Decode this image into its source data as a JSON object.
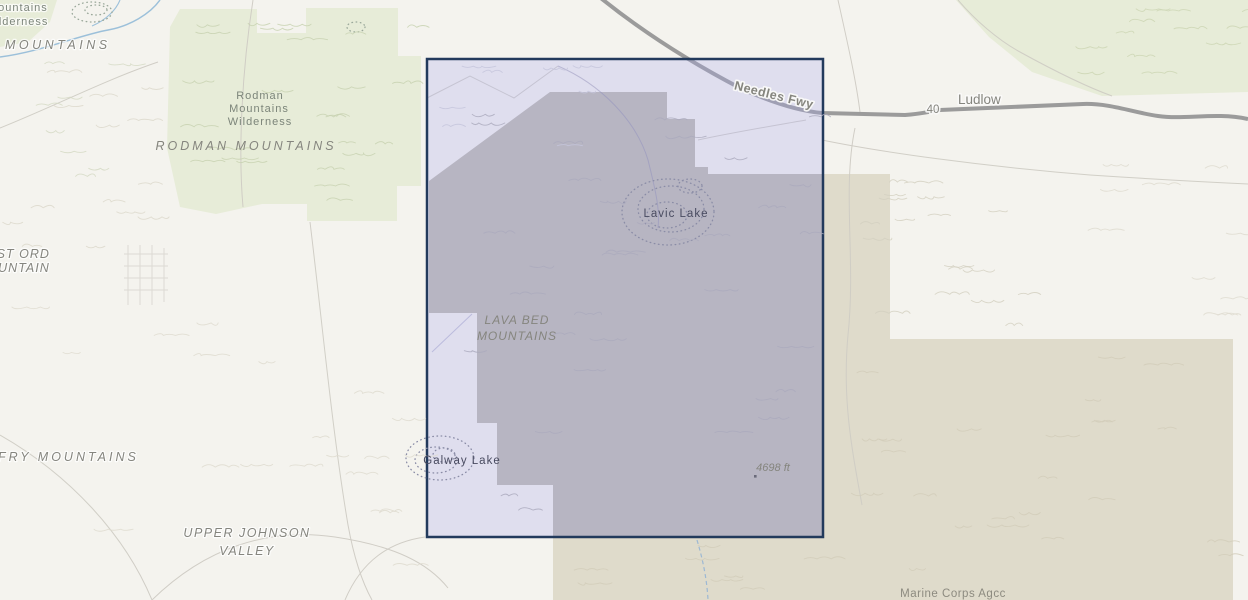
{
  "map": {
    "labels": {
      "topleft_wilderness_line1": "Mountains",
      "topleft_wilderness_line2": "Wilderness",
      "topleft_mountains": "MOUNTAINS",
      "rodman_wilderness_line1": "Rodman",
      "rodman_wilderness_line2": "Mountains",
      "rodman_wilderness_line3": "Wilderness",
      "rodman_mountains": "RODMAN MOUNTAINS",
      "east_ord_line1": "EAST ORD",
      "east_ord_line2": "MOUNTAIN",
      "fry_mountains": "FRY MOUNTAINS",
      "upper_johnson_line1": "UPPER JOHNSON",
      "upper_johnson_line2": "VALLEY",
      "lava_bed_line1": "LAVA BED",
      "lava_bed_line2": "MOUNTAINS",
      "lavic_lake": "Lavic Lake",
      "galway_lake": "Galway Lake",
      "needles_fwy": "Needles Fwy",
      "route_shield": "40",
      "ludlow": "Ludlow",
      "spot_elevation": "4698 ft",
      "marine_corps": "Marine Corps Agcc"
    },
    "colors": {
      "background": "#f4f3ee",
      "wilderness_green": "#e7ecd8",
      "military_tan": "#dfdbcb",
      "selection_fill": "#a8a8f0",
      "selection_border": "#223a5c",
      "highway_gray": "#9b9b9b",
      "river_blue": "#9cc0da",
      "lake_label_blue": "#494b60"
    }
  }
}
